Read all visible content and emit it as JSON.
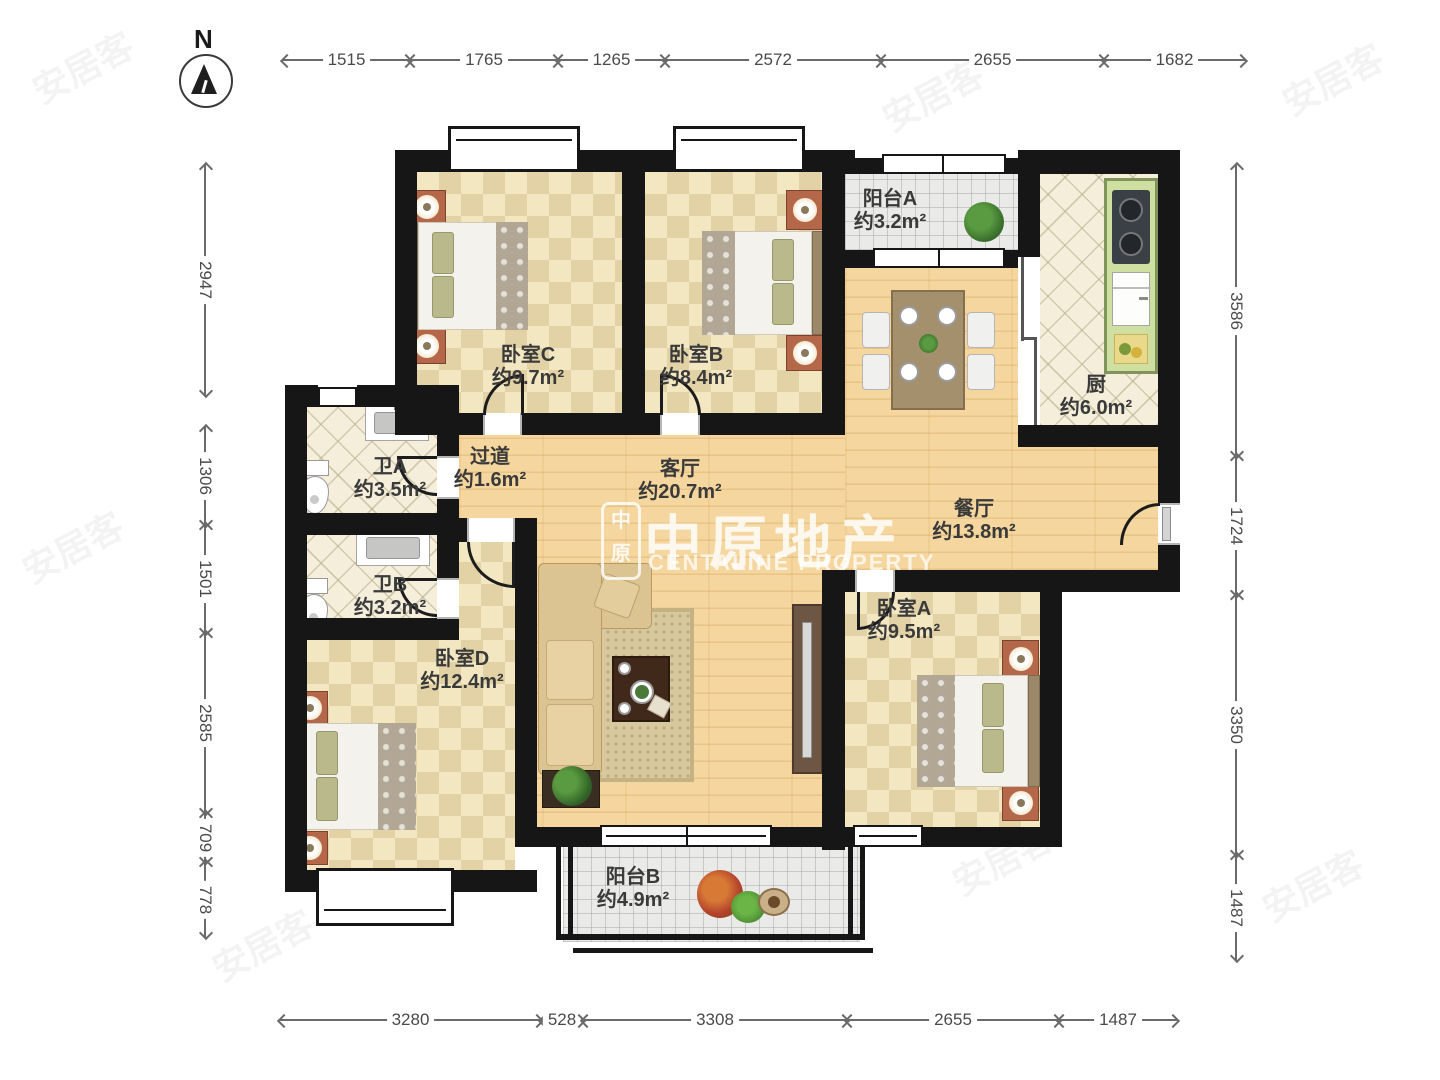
{
  "compass": {
    "label": "N"
  },
  "brand": {
    "seal_top": "中",
    "seal_bottom": "原",
    "name_zh": "中原地产",
    "name_en": "CENTALINE PROPERTY"
  },
  "faint_watermark": "安居客",
  "rooms": {
    "balconyA": {
      "name": "阳台A",
      "area": "约3.2m²"
    },
    "kitchen": {
      "name": "厨",
      "area": "约6.0m²"
    },
    "bedroomC": {
      "name": "卧室C",
      "area": "约9.7m²"
    },
    "bedroomB": {
      "name": "卧室B",
      "area": "约8.4m²"
    },
    "dining": {
      "name": "餐厅",
      "area": "约13.8m²"
    },
    "hallway": {
      "name": "过道",
      "area": "约1.6m²"
    },
    "living": {
      "name": "客厅",
      "area": "约20.7m²"
    },
    "bathA": {
      "name": "卫A",
      "area": "约3.5m²"
    },
    "bathB": {
      "name": "卫B",
      "area": "约3.2m²"
    },
    "bedroomD": {
      "name": "卧室D",
      "area": "约12.4m²"
    },
    "bedroomA": {
      "name": "卧室A",
      "area": "约9.5m²"
    },
    "balconyB": {
      "name": "阳台B",
      "area": "约4.9m²"
    }
  },
  "dimensions": {
    "top": [
      "1515",
      "1765",
      "1265",
      "2572",
      "2655",
      "1682"
    ],
    "left": [
      "2947",
      "1306",
      "1501",
      "2585",
      "709",
      "778"
    ],
    "right": [
      "3586",
      "1724",
      "3350",
      "1487"
    ],
    "bottom": [
      "3280",
      "528",
      "3308",
      "2655",
      "1487"
    ]
  }
}
